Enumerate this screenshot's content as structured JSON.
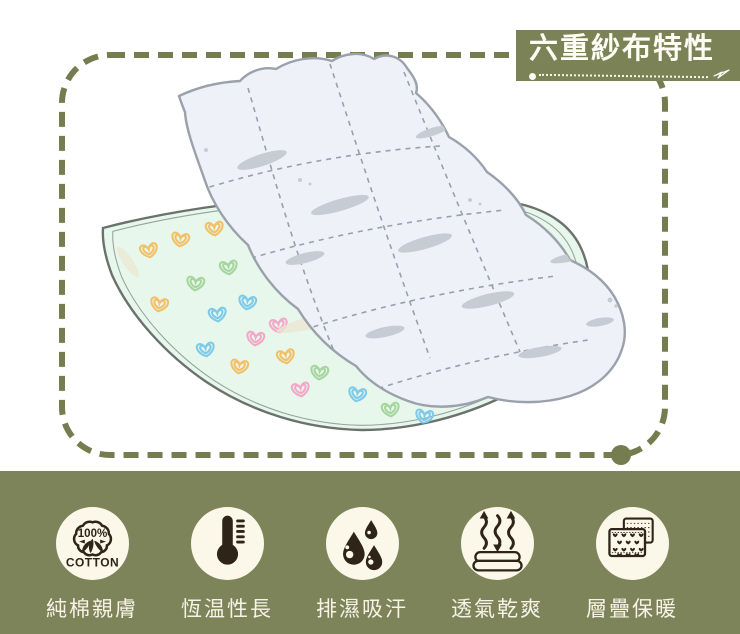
{
  "title_badge": {
    "text": "六重紗布特性"
  },
  "features": [
    {
      "icon": "cotton-100-icon",
      "label": "純棉親膚",
      "icon_text_top": "100%",
      "icon_text_bottom": "COTTON"
    },
    {
      "icon": "thermometer-icon",
      "label": "恆温性長"
    },
    {
      "icon": "water-drops-icon",
      "label": "排濕吸汗"
    },
    {
      "icon": "breathable-blanket-icon",
      "label": "透氣乾爽"
    },
    {
      "icon": "layered-sheets-icon",
      "label": "層疊保暖"
    }
  ],
  "colors": {
    "band_olive": "#7d8459",
    "badge_olive": "#7b8356",
    "dash_border": "#757c4f",
    "icon_circle_bg": "#fbf8ea",
    "icon_glyph": "#2f2418",
    "label_text": "#f6f3e7",
    "title_text": "#fdfdf6",
    "mint_blanket": "#e7f7ec",
    "quilt_fill": "#eef2f8",
    "quilt_outline": "#9aa1ab",
    "heart_orange": "#f1c169",
    "heart_green": "#a6d69e",
    "heart_blue": "#7ecae8",
    "heart_pink": "#f3a8c7"
  }
}
